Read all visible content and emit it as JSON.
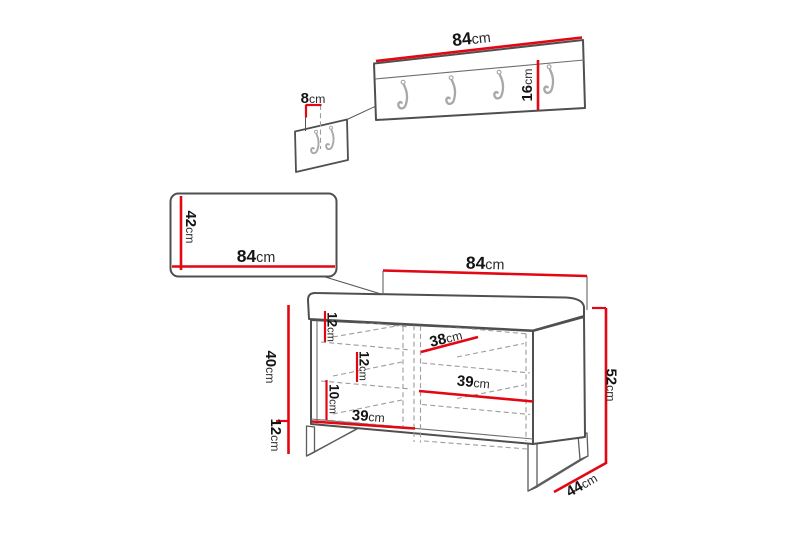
{
  "diagram": {
    "unit": "cm",
    "colors": {
      "dimension_red": "#e30613",
      "outline_gray": "#4f4f4f",
      "dashed_gray": "#9c9c9c"
    },
    "coat_rack": {
      "width": {
        "value": "84",
        "unit": "cm"
      },
      "height": {
        "value": "16",
        "unit": "cm"
      },
      "depth": {
        "value": "8",
        "unit": "cm"
      },
      "hook_count": 4,
      "side_view_hook_count": 2
    },
    "seat_panel": {
      "width": {
        "value": "84",
        "unit": "cm"
      },
      "height": {
        "value": "42",
        "unit": "cm"
      }
    },
    "bench": {
      "width": {
        "value": "84",
        "unit": "cm"
      },
      "total_height": {
        "value": "52",
        "unit": "cm"
      },
      "body_height": {
        "value": "40",
        "unit": "cm"
      },
      "leg_height": {
        "value": "12",
        "unit": "cm"
      },
      "depth": {
        "value": "44",
        "unit": "cm"
      },
      "inner_gap_top": {
        "value": "12",
        "unit": "cm"
      },
      "inner_gap_middle": {
        "value": "12",
        "unit": "cm"
      },
      "inner_gap_bottom": {
        "value": "10",
        "unit": "cm"
      },
      "shelf_width_top": {
        "value": "38",
        "unit": "cm"
      },
      "shelf_width_middle": {
        "value": "39",
        "unit": "cm"
      },
      "shelf_width_bottom": {
        "value": "39",
        "unit": "cm"
      }
    }
  }
}
